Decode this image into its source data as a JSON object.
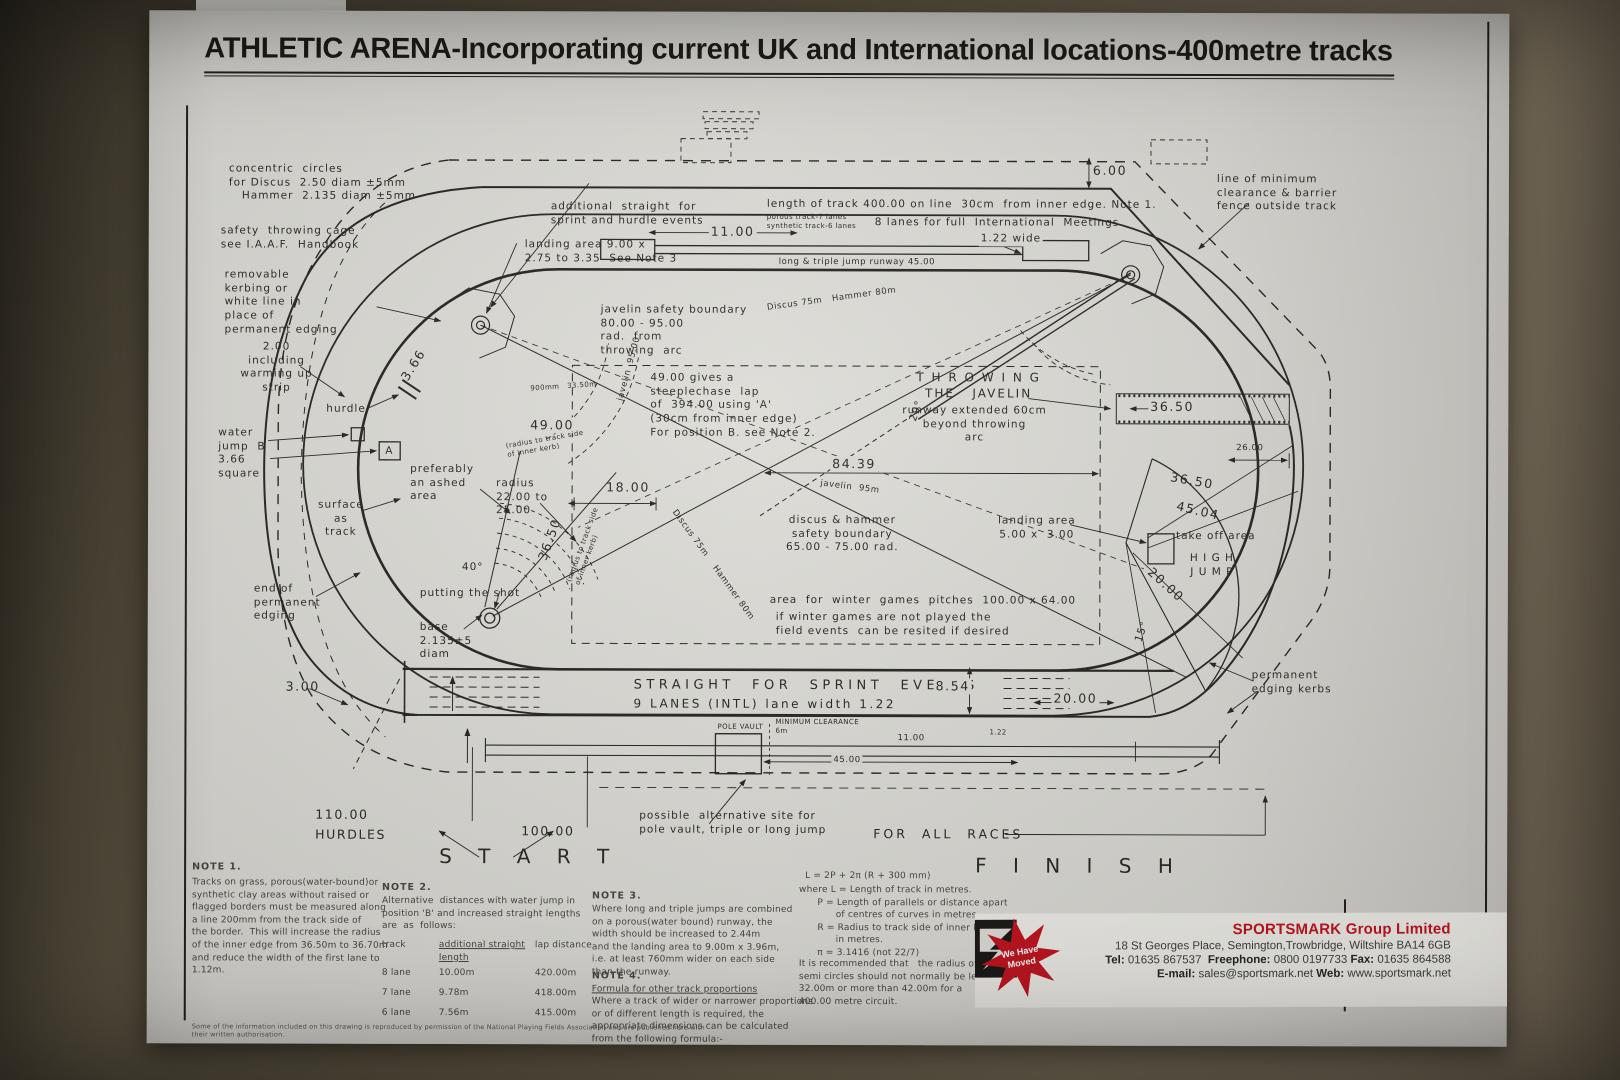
{
  "poster": {
    "title": "ATHLETIC ARENA-Incorporating current UK and International locations-400metre tracks"
  },
  "labels": {
    "concentric_circles": "concentric  circles\nfor Discus  2.50 diam ±5mm\n   Hammer  2.135 diam ±5mm",
    "safety_cage": "safety  throwing cage\nsee I.A.A.F.  Handbook",
    "additional_straight": "additional  straight  for\nsprint and hurdle events",
    "track_length": "length of track 400.00 on line  30cm  from inner edge. Note 1.",
    "lanes_small": "porous track-7 lanes\nsynthetic track-6 lanes",
    "lanes_8": "8 lanes for full  International  Meetings",
    "dim_6": "6.00",
    "clearance_line": "line of minimum\nclearance & barrier\nfence outside track",
    "landing_area_top": "landing area 9.00 x\n2.75 to 3.35  See Note 3",
    "dim_11": "11.00",
    "lane_wide": "1.22 wide",
    "runway_45": "long & triple jump runway 45.00",
    "removable_kerbing": "removable\nkerbing or\nwhite line in\nplace of\npermanent edging",
    "warming_strip": "2.00\nincluding\nwarming up\nstrip",
    "hurdle": "hurdle",
    "hurdle_dim": "900mm   33.50m",
    "water_jump": "water\njump  B\n3.66\nsquare",
    "a_marker": "A",
    "dim_366": "3.66",
    "javelin_boundary": "javelin safety boundary\n80.00 - 95.00\nrad.  from\nthrowing  arc",
    "discus_arc_top": "Discus 75m   Hammer 80m",
    "steeplechase": "49.00 gives a\nsteeplechase  lap\nof  394.00 using 'A'\n(30cm from inner edge)\nFor position B. see Note 2.",
    "dim_49": "49.00",
    "radius_note_49": "(radius to track side\nof inner kerb)",
    "throwing_javelin": "T H R O W I N G\nTHE   JAVELIN",
    "runway_extended": "runway extended 60cm\nbeyond throwing\narc",
    "dim_3650_runway": "36.50",
    "dim_26": "26.00",
    "dim_3650_b": "36.50",
    "dim_4504": "45.04",
    "take_off_area": "take off area",
    "high_jump": "H I G H\nJ U M P",
    "dim_20": "20.00",
    "deg_15": "15°",
    "deg_29": "29°",
    "dim_8439": "84.39",
    "dim_18": "18.00",
    "javelin_95_left": "javelin  95.00",
    "javelin_95_mid": "javelin  95m",
    "preferably_ashed": "preferably\nan ashed\narea",
    "radius_22_25": "radius\n22.00 to\n25.00",
    "dim_3650_left": "36.50",
    "radius_note_left": "(radius to track side\nof inner kerb)",
    "surface_as_track": "surface\nas\ntrack",
    "deg_40": "40°",
    "putting_shot": "putting the shot",
    "end_permanent": "end of\npermanent\nedging",
    "base_diam": "base\n2.135±5\ndiam",
    "discus_hammer_boundary": "discus & hammer\nsafety boundary\n65.00 - 75.00 rad.",
    "landing_area_right": "landing area\n5.00 x  3.00",
    "winter_games_1": "area  for  winter  games  pitches  100.00 x 64.00",
    "winter_games_2": "if winter games are not played the\nfield events  can be resited if desired",
    "discus_hammer_diag": "Discus 75m    Hammer 80m",
    "dim_300": "3.00",
    "sprint_events": "STRAIGHT  FOR  SPRINT  EVENTS",
    "nine_lanes": "9 LANES (INTL) lane width 1.22",
    "dim_854": "8.54",
    "dim_2000": "20.00",
    "permanent_kerbs": "permanent\nedging kerbs",
    "pole_vault": "POLE VAULT",
    "min_clearance": "MINIMUM CLEARANCE\n6m",
    "dim_1100b": "11.00",
    "dim_122": "1.22",
    "dim_4500": "45.00",
    "hurdles_110": "110.00\nHURDLES",
    "dim_100": "100.00",
    "start": "S T A R T",
    "alt_site": "possible  alternative site for\npole vault, triple or long jump",
    "for_all_races": "FOR  ALL  RACES",
    "finish": "F I N I S H"
  },
  "notes": {
    "note1": {
      "heading": "NOTE 1.",
      "body": "Tracks on grass, porous(water-bound)or\nsynthetic clay areas without raised or\nflagged borders must be measured along\na line 200mm from the track side of\nthe border.  This will increase the radius\nof the inner edge from 36.50m to 36.70m\nand reduce the width of the first lane to\n1.12m."
    },
    "note2": {
      "heading": "NOTE 2.",
      "body": "Alternative  distances with water jump in\nposition 'B' and increased straight lengths\nare  as  follows:",
      "table": {
        "headers": [
          "track",
          "additional straight\nlength",
          "lap distance"
        ],
        "rows": [
          [
            "8 lane",
            "10.00m",
            "420.00m"
          ],
          [
            "7 lane",
            "9.78m",
            "418.00m"
          ],
          [
            "6 lane",
            "7.56m",
            "415.00m"
          ]
        ]
      }
    },
    "note3": {
      "heading": "NOTE 3.",
      "body": "Where long and triple jumps are combined\non a porous(water bound) runway, the\nwidth should be increased to 2.44m\nand the landing area to 9.00m x 3.96m,\ni.e. at least 760mm wider on each side\nthan the runway."
    },
    "note4": {
      "heading": "NOTE 4.",
      "title": "Formula for other track proportions",
      "body": "Where a track of wider or narrower proportions\nor of different length is required, the\nappropriate dimensions can be calculated\nfrom the following formula:-"
    },
    "formula": {
      "line1": "L = 2P + 2π (R + 300 mm)",
      "lines": "where L = Length of track in metres.\n      P = Length of parallels or distance apart\n            of centres of curves in metres.\n      R = Radius to track side of inner kerb\n            in metres.\n      π = 3.1416 (not 22/7)",
      "recommendation": "It is recommended that   the radius of the\nsemi circles should not normally be less than\n32.00m or more than 42.00m for a\n400.00 metre circuit."
    }
  },
  "vendor": {
    "moved_badge": "We Have\nMoved",
    "name": "SPORTSMARK Group Limited",
    "address": "18 St Georges Place, Semington,Trowbridge, Wiltshire BA14 6GB",
    "tel_label": "Tel:",
    "tel": "01635 867537",
    "freephone_label": "Freephone:",
    "freephone": "0800 0197733",
    "fax_label": "Fax:",
    "fax": "01635 864588",
    "email_label": "E-mail:",
    "email": "sales@sportsmark.net",
    "web_label": "Web:",
    "web": "www.sportsmark.net",
    "accent_color": "#bf101b"
  },
  "footer": {
    "disclaimer": "Some of the information included on this drawing is reproduced by permission of the National Playing Fields Association and are published here with their written authorisation."
  }
}
